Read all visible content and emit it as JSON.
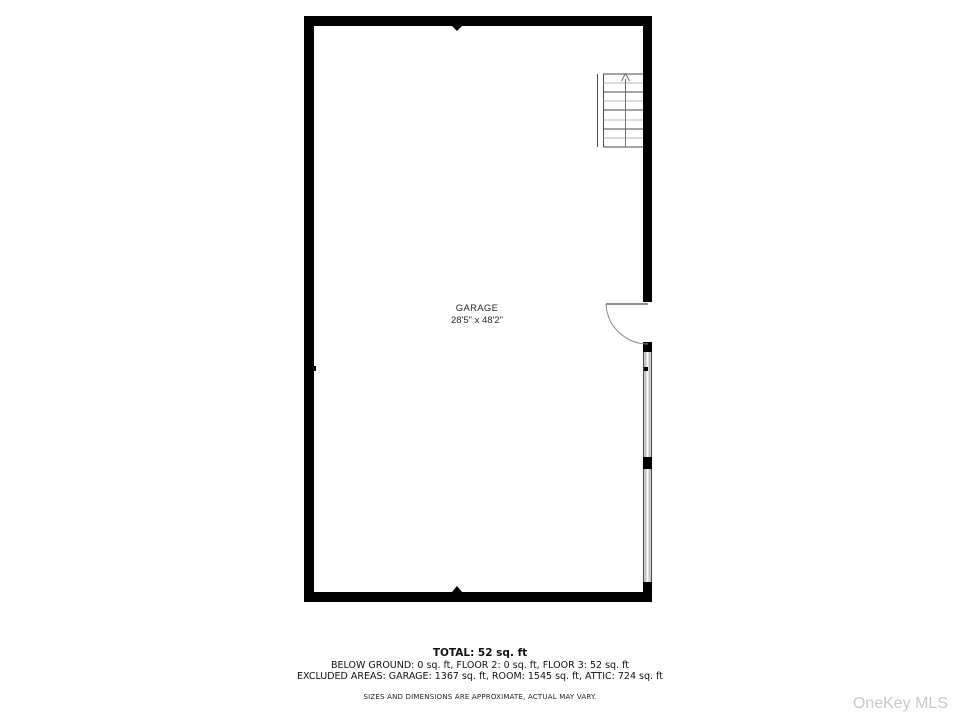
{
  "plan": {
    "room": {
      "label": "GARAGE",
      "dimensions": "28'5\" x 48'2\""
    },
    "icons": {
      "stairs": "stairs-up-icon",
      "door": "door-swing-icon"
    }
  },
  "footer": {
    "total": "TOTAL: 52 sq. ft",
    "floors": "BELOW GROUND: 0 sq. ft, FLOOR 2: 0 sq. ft, FLOOR 3: 52 sq. ft",
    "excluded": "EXCLUDED AREAS: GARAGE: 1367 sq. ft, ROOM: 1545 sq. ft, ATTIC: 724 sq. ft",
    "disclaimer": "SIZES AND DIMENSIONS ARE APPROXIMATE, ACTUAL MAY VARY."
  },
  "watermark": "OneKey MLS",
  "colors": {
    "wall": "#000000",
    "thin_wall_fill": "#c6c6c6",
    "stair_dark": "#4a4a4a",
    "stair_light": "#b5b5b5",
    "watermark_gray": "#c8c8c8",
    "background": "#ffffff"
  }
}
